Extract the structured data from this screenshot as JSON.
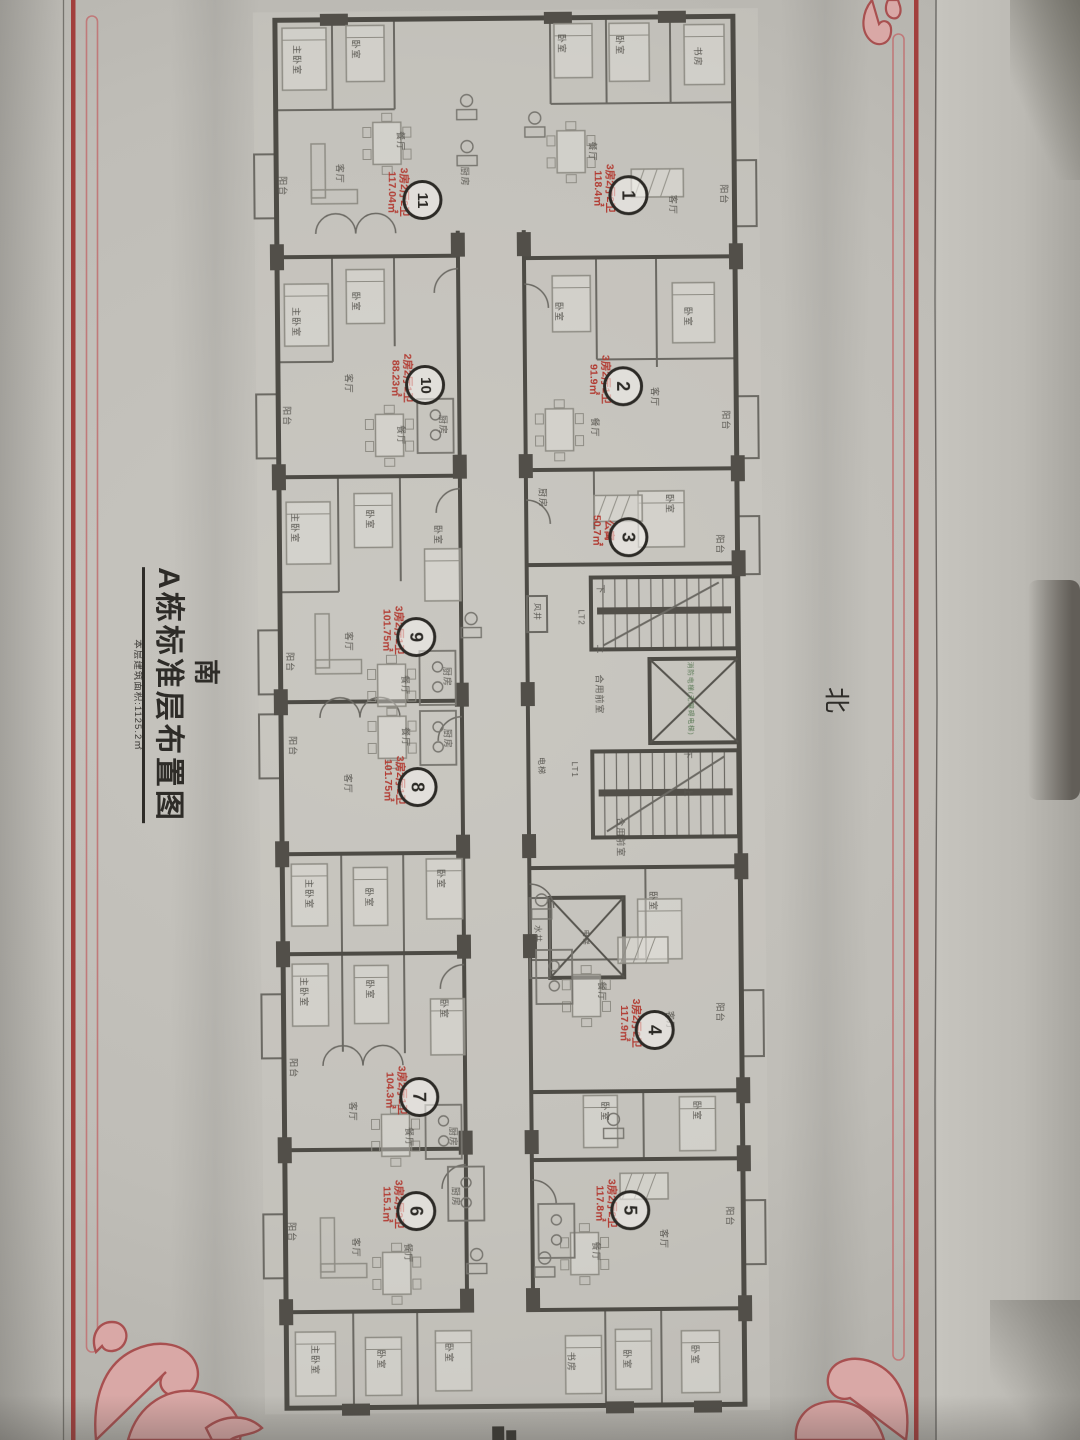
{
  "photo": {
    "compass_south": "南",
    "compass_north": "北",
    "title": "A栋标准层布置图",
    "subtitle": "本层建筑面积:1125.2㎡"
  },
  "units": [
    {
      "no": "1",
      "spec": "3房2厅2卫",
      "area": "118.4㎡",
      "cx": 633,
      "cy": 196,
      "tx": 608,
      "ty": 189
    },
    {
      "no": "2",
      "spec": "3房2厅1卫",
      "area": "91.9㎡",
      "cx": 626,
      "cy": 387,
      "tx": 602,
      "ty": 380
    },
    {
      "no": "3",
      "spec": "公寓",
      "area": "50.7㎡",
      "cx": 630,
      "cy": 538,
      "tx": 604,
      "ty": 531
    },
    {
      "no": "4",
      "spec": "3房2厅2卫",
      "area": "117.9㎡",
      "cx": 652,
      "cy": 1031,
      "tx": 627,
      "ty": 1024
    },
    {
      "no": "5",
      "spec": "3房2厅2卫",
      "area": "117.8㎡",
      "cx": 626,
      "cy": 1211,
      "tx": 601,
      "ty": 1204
    },
    {
      "no": "6",
      "spec": "3房2厅2卫",
      "area": "115.1㎡",
      "cx": 412,
      "cy": 1210,
      "tx": 388,
      "ty": 1203
    },
    {
      "no": "7",
      "spec": "3房2厅1卫",
      "area": "104.3㎡",
      "cx": 416,
      "cy": 1096,
      "tx": 392,
      "ty": 1089
    },
    {
      "no": "8",
      "spec": "3房2厅1卫",
      "area": "101.75㎡",
      "cx": 417,
      "cy": 786,
      "tx": 393,
      "ty": 779
    },
    {
      "no": "9",
      "spec": "3房2厅1卫",
      "area": "101.75㎡",
      "cx": 417,
      "cy": 636,
      "tx": 393,
      "ty": 629
    },
    {
      "no": "10",
      "spec": "2房2厅1卫",
      "area": "88.23㎡",
      "cx": 428,
      "cy": 384,
      "tx": 404,
      "ty": 377
    },
    {
      "no": "11",
      "spec": "3房2厅2卫",
      "area": "117.04㎡",
      "cx": 427,
      "cy": 199,
      "tx": 402,
      "ty": 191
    }
  ],
  "room_labels": [
    {
      "t": "主卧室",
      "x": 303,
      "y": 58
    },
    {
      "t": "卧室",
      "x": 362,
      "y": 48
    },
    {
      "t": "厨房",
      "x": 470,
      "y": 176
    },
    {
      "t": "客厅",
      "x": 345,
      "y": 172
    },
    {
      "t": "餐厅",
      "x": 406,
      "y": 140
    },
    {
      "t": "阳台",
      "x": 288,
      "y": 184
    },
    {
      "t": "卧室",
      "x": 568,
      "y": 44
    },
    {
      "t": "卧室",
      "x": 626,
      "y": 46
    },
    {
      "t": "书房",
      "x": 704,
      "y": 58
    },
    {
      "t": "餐厅",
      "x": 598,
      "y": 152
    },
    {
      "t": "客厅",
      "x": 678,
      "y": 206
    },
    {
      "t": "阳台",
      "x": 729,
      "y": 196
    },
    {
      "t": "主卧室",
      "x": 300,
      "y": 320
    },
    {
      "t": "卧室",
      "x": 360,
      "y": 300
    },
    {
      "t": "客厅",
      "x": 352,
      "y": 382
    },
    {
      "t": "餐厅",
      "x": 404,
      "y": 434
    },
    {
      "t": "厨房",
      "x": 446,
      "y": 424
    },
    {
      "t": "阳台",
      "x": 290,
      "y": 414
    },
    {
      "t": "卧室",
      "x": 563,
      "y": 312
    },
    {
      "t": "卧室",
      "x": 692,
      "y": 318
    },
    {
      "t": "客厅",
      "x": 658,
      "y": 398
    },
    {
      "t": "餐厅",
      "x": 598,
      "y": 428
    },
    {
      "t": "阳台",
      "x": 729,
      "y": 422
    },
    {
      "t": "厨房",
      "x": 545,
      "y": 498
    },
    {
      "t": "卧室",
      "x": 672,
      "y": 505
    },
    {
      "t": "阳台",
      "x": 722,
      "y": 546
    },
    {
      "t": "主卧室",
      "x": 297,
      "y": 526
    },
    {
      "t": "卧室",
      "x": 372,
      "y": 518
    },
    {
      "t": "卧室",
      "x": 440,
      "y": 534
    },
    {
      "t": "客厅",
      "x": 350,
      "y": 640
    },
    {
      "t": "餐厅",
      "x": 406,
      "y": 684
    },
    {
      "t": "厨房",
      "x": 448,
      "y": 676
    },
    {
      "t": "阳台",
      "x": 291,
      "y": 660
    },
    {
      "t": "餐厅",
      "x": 406,
      "y": 736
    },
    {
      "t": "厨房",
      "x": 448,
      "y": 738
    },
    {
      "t": "客厅",
      "x": 348,
      "y": 782
    },
    {
      "t": "阳台",
      "x": 293,
      "y": 744
    },
    {
      "t": "主卧室",
      "x": 308,
      "y": 892
    },
    {
      "t": "卧室",
      "x": 368,
      "y": 896
    },
    {
      "t": "卧室",
      "x": 440,
      "y": 878
    },
    {
      "t": "主卧室",
      "x": 302,
      "y": 990
    },
    {
      "t": "卧室",
      "x": 368,
      "y": 988
    },
    {
      "t": "卧室",
      "x": 442,
      "y": 1008
    },
    {
      "t": "客厅",
      "x": 350,
      "y": 1110
    },
    {
      "t": "餐厅",
      "x": 406,
      "y": 1136
    },
    {
      "t": "厨房",
      "x": 450,
      "y": 1136
    },
    {
      "t": "阳台",
      "x": 291,
      "y": 1066
    },
    {
      "t": "客厅",
      "x": 352,
      "y": 1246
    },
    {
      "t": "餐厅",
      "x": 404,
      "y": 1252
    },
    {
      "t": "厨房",
      "x": 452,
      "y": 1196
    },
    {
      "t": "阳台",
      "x": 288,
      "y": 1230
    },
    {
      "t": "主卧室",
      "x": 310,
      "y": 1358
    },
    {
      "t": "卧室",
      "x": 376,
      "y": 1358
    },
    {
      "t": "卧室",
      "x": 444,
      "y": 1352
    },
    {
      "t": "卧室",
      "x": 652,
      "y": 902
    },
    {
      "t": "餐厅",
      "x": 600,
      "y": 992
    },
    {
      "t": "客厅",
      "x": 668,
      "y": 1022
    },
    {
      "t": "阳台",
      "x": 718,
      "y": 1014
    },
    {
      "t": "卧室",
      "x": 602,
      "y": 1112
    },
    {
      "t": "卧室",
      "x": 694,
      "y": 1112
    },
    {
      "t": "客厅",
      "x": 660,
      "y": 1240
    },
    {
      "t": "餐厅",
      "x": 592,
      "y": 1252
    },
    {
      "t": "阳台",
      "x": 726,
      "y": 1218
    },
    {
      "t": "书房",
      "x": 566,
      "y": 1362
    },
    {
      "t": "卧室",
      "x": 622,
      "y": 1360
    },
    {
      "t": "卧室",
      "x": 690,
      "y": 1356
    },
    {
      "t": "风井",
      "x": 538,
      "y": 612,
      "s": 8
    },
    {
      "t": "LT2",
      "x": 582,
      "y": 618,
      "s": 8
    },
    {
      "t": "下",
      "x": 602,
      "y": 590,
      "s": 9
    },
    {
      "t": "上",
      "x": 602,
      "y": 650,
      "s": 9
    },
    {
      "t": "合用前室",
      "x": 600,
      "y": 695,
      "s": 9
    },
    {
      "t": "电梯",
      "x": 541,
      "y": 766,
      "s": 8
    },
    {
      "t": "LT1",
      "x": 574,
      "y": 770,
      "s": 8
    },
    {
      "t": "下",
      "x": 688,
      "y": 756,
      "s": 9
    },
    {
      "t": "上",
      "x": 688,
      "y": 794,
      "s": 9
    },
    {
      "t": "合用前室",
      "x": 620,
      "y": 838,
      "s": 9
    },
    {
      "t": "水井",
      "x": 536,
      "y": 934,
      "s": 8
    },
    {
      "t": "消防电梯(无障碍电梯)",
      "x": 692,
      "y": 700,
      "s": 6.5,
      "c": "#5a7a55"
    },
    {
      "t": "电梯",
      "x": 584,
      "y": 938,
      "s": 7
    }
  ],
  "colors": {
    "wall": "#4d4b45",
    "thin_wall": "#6b6963",
    "column": "#524f49",
    "furniture": "#8f8d85",
    "unit_label_red": "#b23b32",
    "border_red": "#a23f3d",
    "ornament_pink": "#d9a8a6",
    "ornament_line": "#a85050"
  }
}
